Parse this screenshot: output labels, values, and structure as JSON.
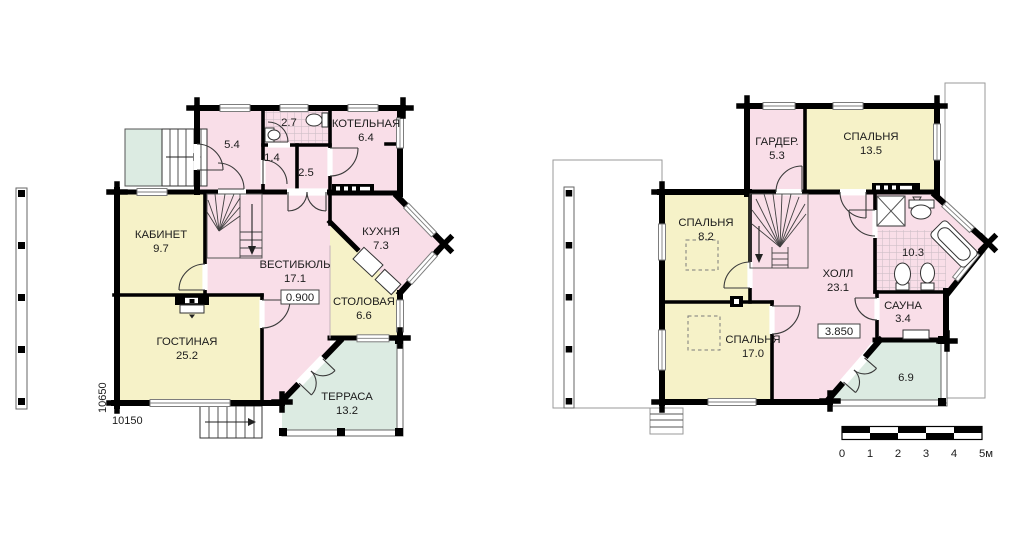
{
  "colors": {
    "room_pink": "#f9dee8",
    "room_yellow": "#f6f2c8",
    "room_green": "#dcebe2",
    "wall": "#000000"
  },
  "floor1": {
    "rooms": {
      "tambour": {
        "area": "5.4"
      },
      "bathroom": {
        "area": "2.7"
      },
      "hallway": {
        "area": "1.4"
      },
      "corridor": {
        "area": "2.5"
      },
      "boiler": {
        "name": "КОТЕЛЬНАЯ",
        "area": "6.4"
      },
      "cabinet": {
        "name": "КАБИНЕТ",
        "area": "9.7"
      },
      "kitchen": {
        "name": "КУХНЯ",
        "area": "7.3"
      },
      "vestibule": {
        "name": "ВЕСТИБЮЛЬ",
        "area": "17.1"
      },
      "dining": {
        "name": "СТОЛОВАЯ",
        "area": "6.6"
      },
      "living": {
        "name": "ГОСТИНАЯ",
        "area": "25.2"
      },
      "terrace": {
        "name": "ТЕРРАСА",
        "area": "13.2"
      }
    },
    "elevation": "0.900",
    "dim_height": "10650",
    "dim_width": "10150"
  },
  "floor2": {
    "rooms": {
      "wardrobe": {
        "name": "ГАРДЕР.",
        "area": "5.3"
      },
      "bedroom_large": {
        "name": "СПАЛЬНЯ",
        "area": "13.5"
      },
      "bedroom_small": {
        "name": "СПАЛЬНЯ",
        "area": "8.2"
      },
      "bedroom_mid": {
        "name": "СПАЛЬНЯ",
        "area": "17.0"
      },
      "hall": {
        "name": "ХОЛЛ",
        "area": "23.1"
      },
      "bathroom": {
        "area": "10.3"
      },
      "sauna": {
        "name": "САУНА",
        "area": "3.4"
      },
      "balcony": {
        "area": "6.9"
      }
    },
    "elevation": "3.850"
  },
  "scale_bar": {
    "labels": [
      "0",
      "1",
      "2",
      "3",
      "4",
      "5м"
    ]
  }
}
